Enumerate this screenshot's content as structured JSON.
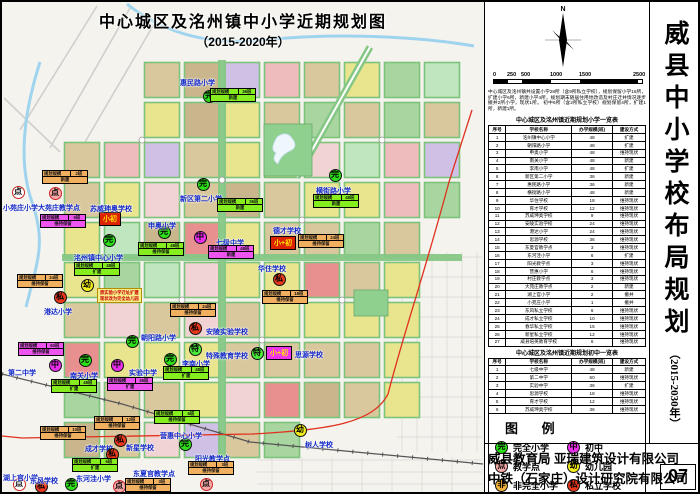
{
  "sheet": {
    "map_title_line1": "中心城区及洺州镇中小学近期规划图",
    "map_title_line2": "（2015-2020年）"
  },
  "panel": {
    "north_label": "N",
    "scale": {
      "labels": [
        "0",
        "250",
        "500",
        "1000",
        "1500",
        "2500 m"
      ],
      "label_pos": [
        0,
        14,
        28,
        57,
        86,
        140
      ],
      "segments": [
        [
          0,
          14
        ],
        [
          28,
          29
        ],
        [
          86,
          58
        ]
      ]
    },
    "description_lines": [
      "中心城区及洺州镇共设置小学28所（含9所私立学校），规划保留小学16所，",
      "扩建小学6所，新建小学4所，规划期末随居住用地改造及村庄迁并情况逐步撤并2",
      "所小学，现状1所。  初中6所（含2所私立学校）规划保留4所，扩建1所，",
      "新建1所。"
    ],
    "table_primary": {
      "title": "中心城区及洺州镇近期规划小学一览表",
      "headers": [
        "序号",
        "学校名称",
        "办学规模(班)",
        "建设方式"
      ],
      "rows": [
        [
          "1",
          "洺州镇中心小学",
          "48",
          "扩建"
        ],
        [
          "2",
          "朝阳路小学",
          "48",
          "扩建"
        ],
        [
          "3",
          "申奥小学",
          "48",
          "维持现状"
        ],
        [
          "4",
          "南关小学",
          "48",
          "新建"
        ],
        [
          "5",
          "李南小学",
          "48",
          "扩建"
        ],
        [
          "6",
          "新区第二小学",
          "36",
          "新建"
        ],
        [
          "7",
          "惠民路小学",
          "36",
          "新建"
        ],
        [
          "8",
          "横街路小学",
          "48",
          "新建"
        ],
        [
          "9",
          "华住学校",
          "18",
          "维持现状"
        ],
        [
          "10",
          "育才学校",
          "12",
          "维持现状"
        ],
        [
          "11",
          "苏威珅奥学校",
          "9",
          "维持现状"
        ],
        [
          "12",
          "安陵实验学校",
          "24",
          "维持现状"
        ],
        [
          "13",
          "港达小学",
          "24",
          "维持现状"
        ],
        [
          "14",
          "思源学校",
          "36",
          "维持现状"
        ],
        [
          "15",
          "东夏官教学点",
          "3",
          "维持现状"
        ],
        [
          "16",
          "东河洼小学",
          "6",
          "扩建"
        ],
        [
          "17",
          "阳光教学点",
          "3",
          "维持现状"
        ],
        [
          "18",
          "营惠小学",
          "6",
          "维持现状"
        ],
        [
          "19",
          "村庄教学点",
          "3",
          "维持现状"
        ],
        [
          "20",
          "大苑庄教学点",
          "2",
          "新建"
        ],
        [
          "21",
          "湖上官小学",
          "2",
          "撤并"
        ],
        [
          "22",
          "小苑庄小学",
          "1",
          "撤并"
        ],
        [
          "23",
          "东风私立学校",
          "6",
          "维持现状"
        ],
        [
          "24",
          "成才私立学校",
          "10",
          "维持现状"
        ],
        [
          "25",
          "春华私立学校",
          "15",
          "维持现状"
        ],
        [
          "26",
          "新星私立学校",
          "12",
          "维持现状"
        ],
        [
          "27",
          "威县培英教育学校",
          "6",
          "维持现状"
        ]
      ]
    },
    "table_middle": {
      "title": "中心城区及洺州镇近期规划初中一览表",
      "headers": [
        "序号",
        "学校名称",
        "办学规模(班)",
        "建设方式"
      ],
      "rows": [
        [
          "1",
          "七级中学",
          "48",
          "新建"
        ],
        [
          "2",
          "第二中学",
          "60",
          "维持现状"
        ],
        [
          "3",
          "实验中学",
          "36",
          "扩建"
        ],
        [
          "4",
          "思源学校",
          "18",
          "维持现状"
        ],
        [
          "5",
          "育才学校",
          "12",
          "维持现状"
        ],
        [
          "6",
          "苏威珅奥学校",
          "36",
          "维持现状"
        ]
      ]
    },
    "legend": {
      "title": "图  例",
      "items": [
        {
          "glyph": "完",
          "color": "#2ee019",
          "label": "完全小学"
        },
        {
          "glyph": "中",
          "color": "#e92fe9",
          "label": "初中"
        },
        {
          "glyph": "点",
          "color": "#f6a9a9",
          "label": "教学点"
        },
        {
          "glyph": "幼",
          "color": "#f2ee1a",
          "label": "幼儿园"
        },
        {
          "glyph": "非",
          "color": "#f5b43a",
          "label": "非完全小学"
        },
        {
          "glyph": "私",
          "color": "#e8391d",
          "label": "私立学校"
        }
      ]
    },
    "side_title": "威县中小学校布局规划",
    "side_subtitle": "（2015-2030年）",
    "footer": {
      "line1": "威县教育局  亚瑞建筑设计有限公司",
      "line2": "中铁（石家庄）设计研究院有限公司",
      "page": "07"
    }
  },
  "map": {
    "palette": [
      "#d9c79d",
      "#e9e48e",
      "#d9c79d",
      "#eebcbc",
      "#e9e48e",
      "#c9b68d",
      "#f1d3d3",
      "#d9c79d",
      "#a9d6a0",
      "#e9e48e",
      "#d9c79d",
      "#e89090",
      "#cfc0e6",
      "#e9e48e",
      "#d9c79d",
      "#bfe6bf"
    ],
    "marker_styles": {
      "wan": {
        "bg": "#2ee019",
        "glyph": "完",
        "ring": "#111"
      },
      "zhong": {
        "bg": "#e92fe9",
        "glyph": "中",
        "ring": "#111"
      },
      "dian": {
        "bg": "#f6a9a9",
        "glyph": "点",
        "ring": "#c22"
      },
      "dianw": {
        "bg": "#ffffff",
        "glyph": "点",
        "ring": "#c22"
      },
      "you": {
        "bg": "#f2ee1a",
        "glyph": "幼",
        "ring": "#111"
      },
      "si": {
        "bg": "#e8391d",
        "glyph": "私",
        "ring": "#111"
      },
      "te": {
        "bg": "#4dee3a",
        "glyph": "特",
        "ring": "#111"
      },
      "fei": {
        "bg": "#f5b43a",
        "glyph": "非",
        "ring": "#111"
      }
    },
    "tag_colors": {
      "green": "#86ee1e",
      "orange": "#f0b060",
      "magenta": "#ee55ee"
    },
    "markers": [
      {
        "t": "wan",
        "cx": 207,
        "cy": 94,
        "label": "惠民路小学",
        "lx": 178,
        "ly": 76
      },
      {
        "t": "wan",
        "cx": 201,
        "cy": 182,
        "label": "新区第二小学",
        "lx": 178,
        "ly": 192
      },
      {
        "t": "dianw",
        "cx": 16,
        "cy": 190,
        "label": "小苑庄小学",
        "lx": 1,
        "ly": 201
      },
      {
        "t": "dian",
        "cx": 53,
        "cy": 191,
        "label": "大苑庄教学点",
        "lx": 36,
        "ly": 201
      },
      {
        "t": "wan",
        "cx": 162,
        "cy": 230,
        "label": "申奥小学",
        "lx": 146,
        "ly": 219
      },
      {
        "t": "zhong",
        "cx": 198,
        "cy": 235,
        "label": "七级中学",
        "lx": 214,
        "ly": 236
      },
      {
        "t": "wan",
        "cx": 107,
        "cy": 238,
        "label": "洺州镇中心小学",
        "lx": 72,
        "ly": 251
      },
      {
        "t": "you",
        "cx": 85,
        "cy": 283,
        "label": "",
        "lx": 0,
        "ly": 0
      },
      {
        "t": "si",
        "cx": 58,
        "cy": 295,
        "label": "港达小学",
        "lx": 42,
        "ly": 305
      },
      {
        "t": "si",
        "cx": 277,
        "cy": 277,
        "label": "华住学校",
        "lx": 256,
        "ly": 262
      },
      {
        "t": "wan",
        "cx": 333,
        "cy": 173,
        "label": "横街路小学",
        "lx": 314,
        "ly": 184
      },
      {
        "t": "si",
        "cx": 193,
        "cy": 326,
        "label": "安陵实验学校",
        "lx": 204,
        "ly": 325
      },
      {
        "t": "te",
        "cx": 193,
        "cy": 347,
        "label": "特殊教育学校",
        "lx": 204,
        "ly": 349
      },
      {
        "t": "wan",
        "cx": 130,
        "cy": 339,
        "label": "朝阳路小学",
        "lx": 139,
        "ly": 331
      },
      {
        "t": "zhong",
        "cx": 53,
        "cy": 363,
        "label": "第二中学",
        "lx": 6,
        "ly": 366
      },
      {
        "t": "wan",
        "cx": 83,
        "cy": 358,
        "label": "南关小学",
        "lx": 68,
        "ly": 369
      },
      {
        "t": "zhong",
        "cx": 115,
        "cy": 363,
        "label": "实验中学",
        "lx": 127,
        "ly": 366
      },
      {
        "t": "wan",
        "cx": 168,
        "cy": 357,
        "label": "李南小学",
        "lx": 180,
        "ly": 357
      },
      {
        "t": "te",
        "cx": 255,
        "cy": 351,
        "label": "",
        "lx": 0,
        "ly": 0
      },
      {
        "t": "wan",
        "cx": 183,
        "cy": 442,
        "label": "营惠中心小学",
        "lx": 158,
        "ly": 429
      },
      {
        "t": "si",
        "cx": 118,
        "cy": 438,
        "label": "成才学校",
        "lx": 83,
        "ly": 442
      },
      {
        "t": "si",
        "cx": 110,
        "cy": 452,
        "label": "新星学校",
        "lx": 124,
        "ly": 441
      },
      {
        "t": "dianw",
        "cx": 17,
        "cy": 482,
        "label": "湖上官小学",
        "lx": 1,
        "ly": 471
      },
      {
        "t": "si",
        "cx": 39,
        "cy": 484,
        "label": "东风学校",
        "lx": 28,
        "ly": 474
      },
      {
        "t": "wan",
        "cx": 69,
        "cy": 482,
        "label": "东河洼小学",
        "lx": 74,
        "ly": 472
      },
      {
        "t": "dian",
        "cx": 117,
        "cy": 484,
        "label": "东夏官教学点",
        "lx": 131,
        "ly": 467
      },
      {
        "t": "dian",
        "cx": 204,
        "cy": 482,
        "label": "阳光教学点",
        "lx": 193,
        "ly": 452
      },
      {
        "t": "you",
        "cx": 298,
        "cy": 428,
        "label": "树人学校",
        "lx": 303,
        "ly": 438
      }
    ],
    "boxes": [
      {
        "text": "小初",
        "bg": "#dd2200",
        "fg": "#ffe400",
        "x": 97,
        "y": 210,
        "label": "苏威珅奥学校",
        "lx": 88,
        "ly": 202
      },
      {
        "text": "小+初",
        "bg": "#dd2200",
        "fg": "#ffe400",
        "x": 268,
        "y": 234,
        "label": "德才学校",
        "lx": 271,
        "ly": 224
      },
      {
        "text": "小+初",
        "bg": "#ee33ee",
        "fg": "#ffe400",
        "x": 264,
        "y": 344,
        "label": "思源学校",
        "lx": 293,
        "ly": 348
      }
    ],
    "tags": [
      {
        "c": "green",
        "k": "规划规模",
        "v": "36班",
        "b": "新建",
        "x": 208,
        "y": 86
      },
      {
        "c": "green",
        "k": "规划规模",
        "v": "36班",
        "b": "新建",
        "x": 215,
        "y": 196
      },
      {
        "c": "orange",
        "k": "规划规模",
        "v": "2班",
        "b": "新建",
        "x": 40,
        "y": 168
      },
      {
        "c": "magenta",
        "k": "规划规模",
        "v": "9班",
        "b": "维持保留",
        "x": 38,
        "y": 212
      },
      {
        "c": "green",
        "k": "规划规模",
        "v": "48班",
        "b": "维持保留",
        "x": 136,
        "y": 240
      },
      {
        "c": "magenta",
        "k": "规划规模",
        "v": "48班",
        "b": "新建",
        "x": 206,
        "y": 243
      },
      {
        "c": "green",
        "k": "规划规模",
        "v": "48班",
        "b": "扩建",
        "x": 72,
        "y": 260
      },
      {
        "c": "orange",
        "k": "规划规模",
        "v": "24班",
        "b": "维持保留",
        "x": 296,
        "y": 232
      },
      {
        "c": "orange",
        "k": "规划规模",
        "v": "18班",
        "b": "维持保留",
        "x": 260,
        "y": 288
      },
      {
        "c": "green",
        "k": "规划规模",
        "v": "48班",
        "b": "新建",
        "x": 311,
        "y": 192
      },
      {
        "c": "orange",
        "k": "规划规模",
        "v": "24班",
        "b": "维持保留",
        "x": 15,
        "y": 272
      },
      {
        "c": "orange",
        "k": "规划规模",
        "v": "24班",
        "b": "维持保留",
        "x": 168,
        "y": 301
      },
      {
        "c": "magenta",
        "k": "规划规模",
        "v": "60班",
        "b": "维持保留",
        "x": 16,
        "y": 340
      },
      {
        "c": "green",
        "k": "规划规模",
        "v": "48班",
        "b": "扩建",
        "x": 49,
        "y": 377
      },
      {
        "c": "magenta",
        "k": "规划规模",
        "v": "36班",
        "b": "扩建",
        "x": 105,
        "y": 375
      },
      {
        "c": "green",
        "k": "规划规模",
        "v": "48班",
        "b": "扩建",
        "x": 161,
        "y": 364
      },
      {
        "c": "green",
        "k": "规划规模",
        "v": "6班",
        "b": "维持保留",
        "x": 152,
        "y": 408
      },
      {
        "c": "orange",
        "k": "规划规模",
        "v": "10班",
        "b": "维持保留",
        "x": 38,
        "y": 424
      },
      {
        "c": "orange",
        "k": "规划规模",
        "v": "12班",
        "b": "维持保留",
        "x": 92,
        "y": 414
      },
      {
        "c": "green",
        "k": "规划规模",
        "v": "6班",
        "b": "扩建",
        "x": 70,
        "y": 456
      },
      {
        "c": "orange",
        "k": "规划规模",
        "v": "3班",
        "b": "维持保留",
        "x": 123,
        "y": 476
      },
      {
        "c": "orange",
        "k": "规划规模",
        "v": "3班",
        "b": "维持保留",
        "x": 186,
        "y": 459
      }
    ],
    "note": {
      "lines": [
        "原实验小学迁址扩建",
        "现状改为完全幼儿园"
      ],
      "x": 95,
      "y": 286
    }
  }
}
